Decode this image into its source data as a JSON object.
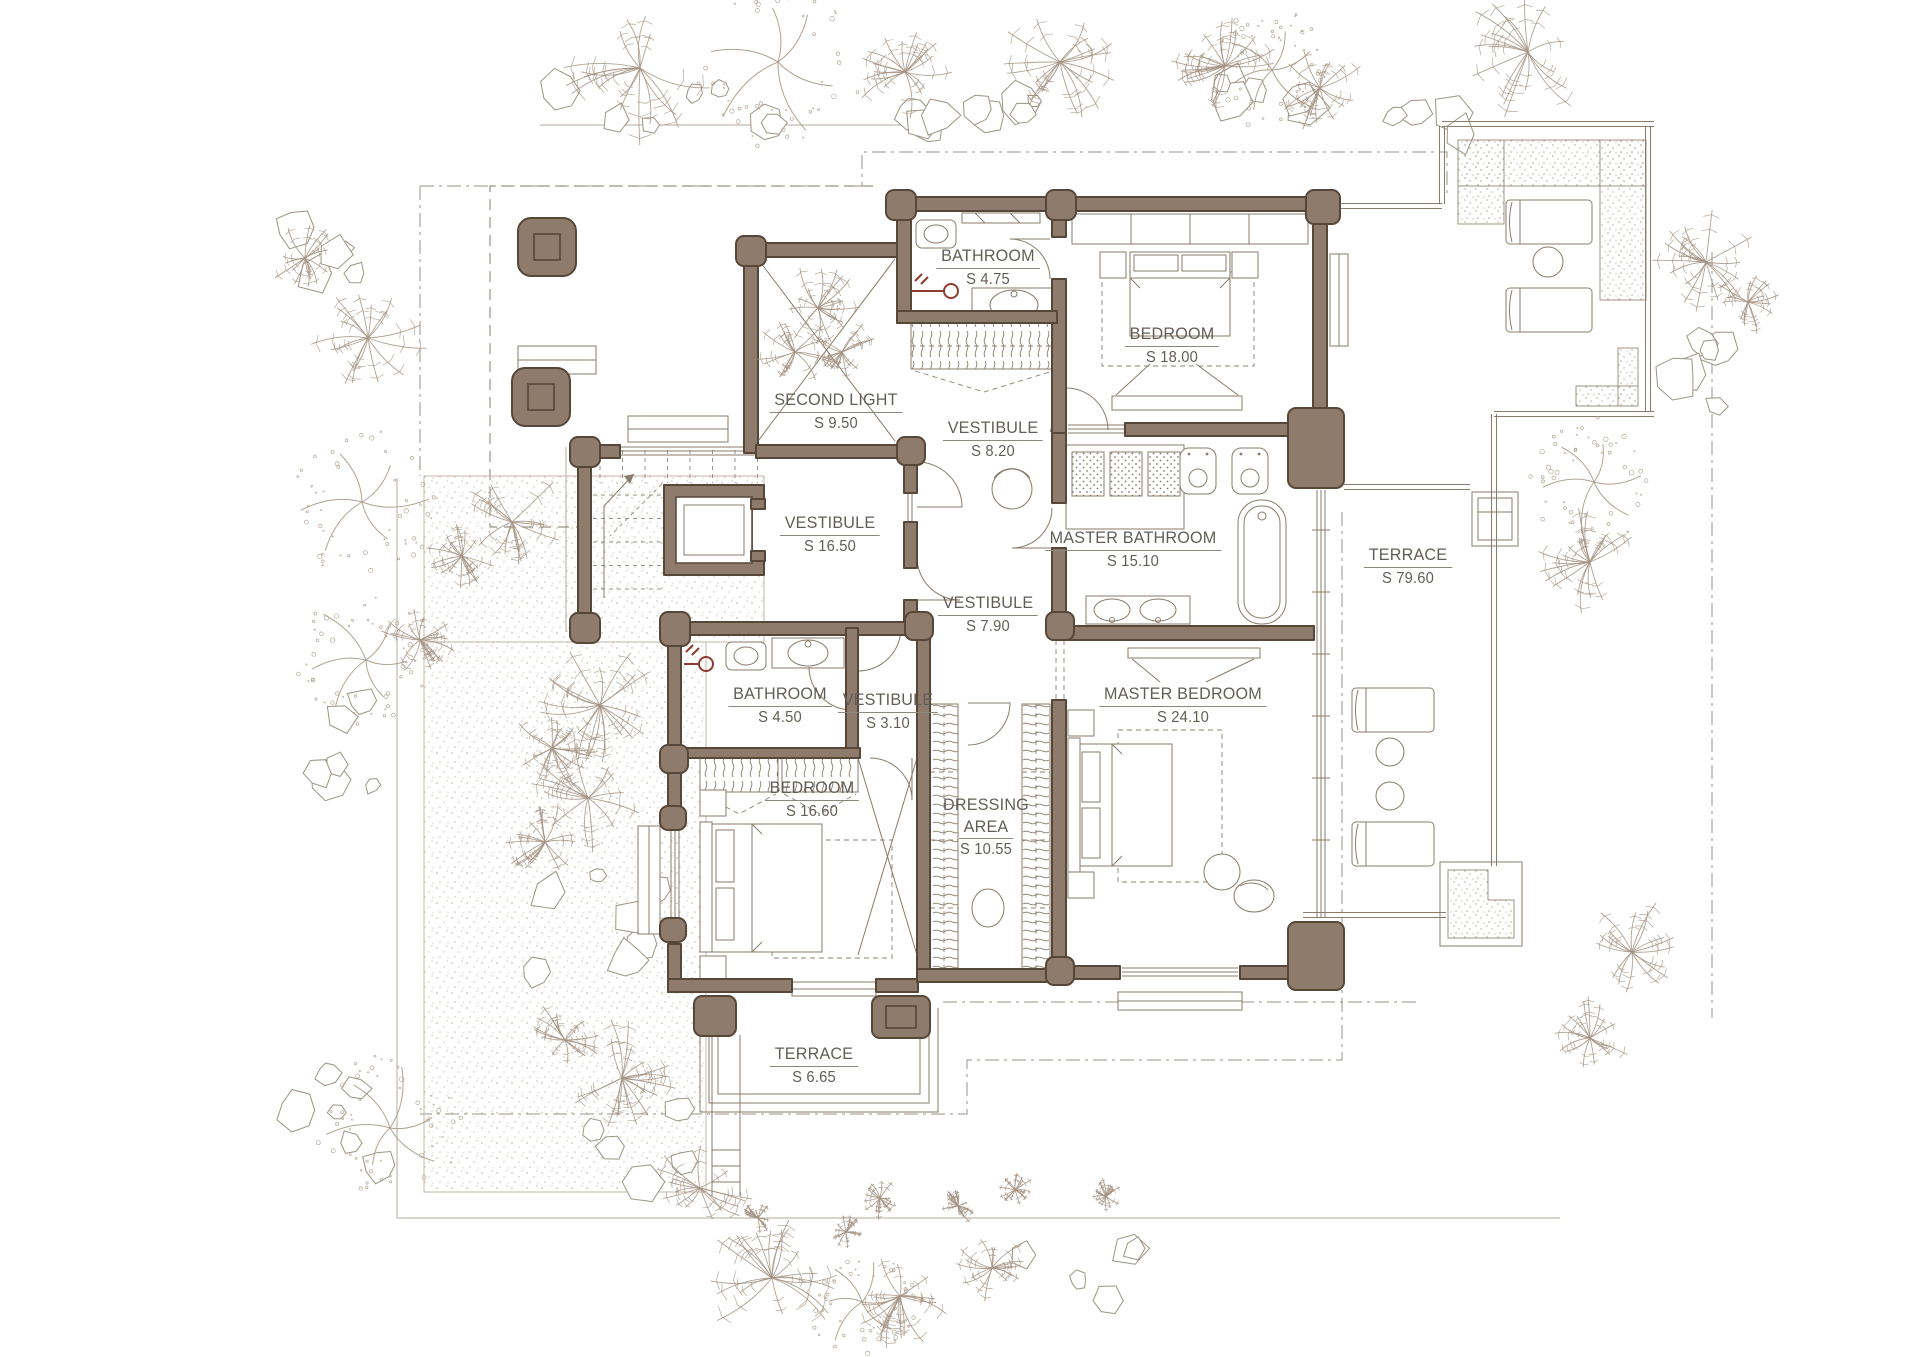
{
  "drawing": {
    "kind": "architectural floor plan",
    "colors": {
      "wall_fill": "#8f7b6c",
      "wall_outline": "#574739",
      "furniture_line": "#8a7b6b",
      "site_line": "#b3aa9c",
      "dash_line": "#9a9288",
      "label_text": "#615e57",
      "vegetation": "#a39282",
      "accent_red": "#8f3c30"
    }
  },
  "rooms": [
    {
      "id": "bathroom-1",
      "lines": [
        "BATHROOM"
      ],
      "area": "S 4.75",
      "x": 988,
      "y": 246
    },
    {
      "id": "bedroom-1",
      "lines": [
        "BEDROOM"
      ],
      "area": "S 18.00",
      "x": 1172,
      "y": 324
    },
    {
      "id": "second-light",
      "lines": [
        "SECOND LIGHT"
      ],
      "area": "S 9.50",
      "x": 836,
      "y": 390
    },
    {
      "id": "vestibule-1",
      "lines": [
        "VESTIBULE"
      ],
      "area": "S 8.20",
      "x": 993,
      "y": 418
    },
    {
      "id": "vestibule-main",
      "lines": [
        "VESTIBULE"
      ],
      "area": "S 16.50",
      "x": 830,
      "y": 513
    },
    {
      "id": "master-bathroom",
      "lines": [
        "MASTER BATHROOM"
      ],
      "area": "S 15.10",
      "x": 1133,
      "y": 528
    },
    {
      "id": "terrace-right",
      "lines": [
        "TERRACE"
      ],
      "area": "S 79.60",
      "x": 1408,
      "y": 545
    },
    {
      "id": "vestibule-2",
      "lines": [
        "VESTIBULE"
      ],
      "area": "S 7.90",
      "x": 988,
      "y": 593
    },
    {
      "id": "bathroom-2",
      "lines": [
        "BATHROOM"
      ],
      "area": "S 4.50",
      "x": 780,
      "y": 684
    },
    {
      "id": "vestibule-3",
      "lines": [
        "VESTIBULE"
      ],
      "area": "S 3.10",
      "x": 888,
      "y": 690
    },
    {
      "id": "master-bedroom",
      "lines": [
        "MASTER BEDROOM"
      ],
      "area": "S 24.10",
      "x": 1183,
      "y": 684
    },
    {
      "id": "bedroom-2",
      "lines": [
        "BEDROOM"
      ],
      "area": "S 16.60",
      "x": 812,
      "y": 778
    },
    {
      "id": "dressing-area",
      "lines": [
        "DRESSING",
        "AREA"
      ],
      "area": "S 10.55",
      "x": 986,
      "y": 795
    },
    {
      "id": "terrace-bottom",
      "lines": [
        "TERRACE"
      ],
      "area": "S 6.65",
      "x": 814,
      "y": 1044
    }
  ]
}
